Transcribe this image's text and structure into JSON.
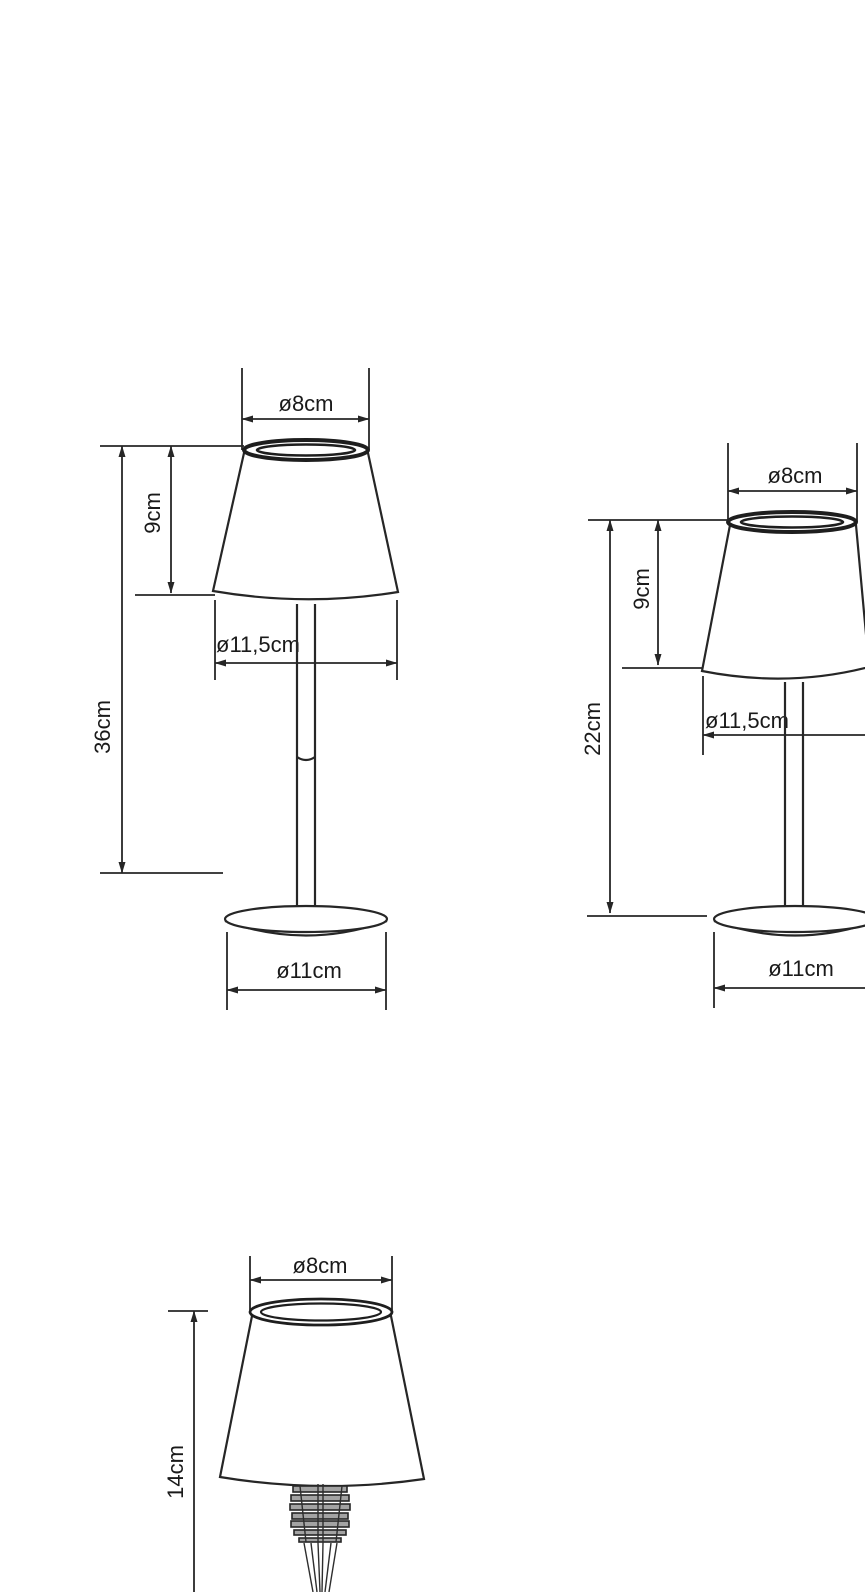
{
  "drawing": {
    "kind": "technical dimension drawing",
    "subject": "cordless table lamps, three size variants, front views with dimensions",
    "background_color": "#ffffff",
    "line_color": "#262626",
    "text_color": "#1a1a1a",
    "views": [
      {
        "id": "lamp-tall",
        "description": "tall table lamp with stem and round base",
        "labels": {
          "top_diameter": "ø8cm",
          "shade_height": "9cm",
          "shade_diameter": "ø11,5cm",
          "total_height": "36cm",
          "base_diameter": "ø11cm"
        }
      },
      {
        "id": "lamp-medium",
        "description": "medium table lamp with stem and round base (partially cropped at right edge)",
        "labels": {
          "top_diameter": "ø8cm",
          "shade_height": "9cm",
          "shade_diameter": "ø11,5cm",
          "total_height": "22cm",
          "base_diameter": "ø11cm"
        }
      },
      {
        "id": "lamp-bottle-stopper",
        "description": "lamp shade with ribbed bottle-stopper spike (cropped at bottom edge)",
        "labels": {
          "top_diameter": "ø8cm",
          "total_height": "14cm"
        }
      }
    ]
  }
}
